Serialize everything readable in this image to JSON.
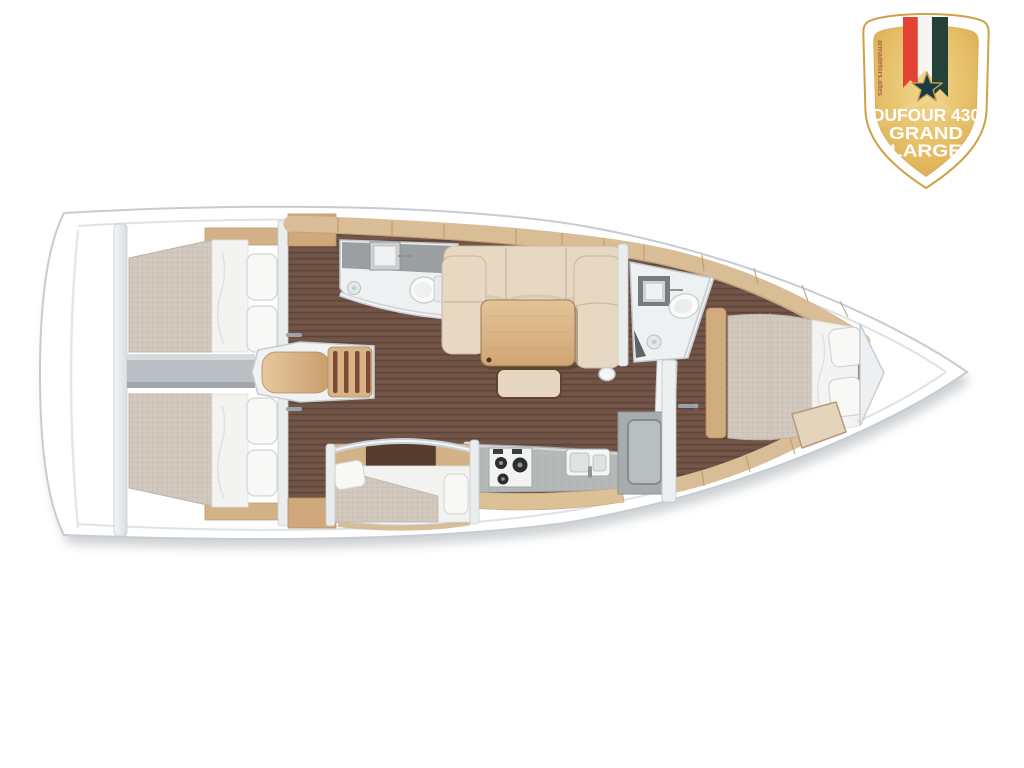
{
  "badge": {
    "title_line1": "DUFOUR 430",
    "title_line2": "GRAND",
    "title_line3": "LARGE",
    "watermark": "armadefors.altes",
    "colors": {
      "gold": "#e2b45f",
      "gold_light": "#f2d88f",
      "gold_dark": "#d3a149",
      "outline_gold": "#cfa045",
      "border_white": "#ffffff",
      "ribbon_red": "#e54236",
      "ribbon_white": "#f7f5f2",
      "ribbon_green": "#24413a",
      "star": "#1c3a46",
      "text": "#ffffff",
      "watermark": "#8a4a42"
    }
  },
  "floorplan": {
    "vessel": "sailboat-deck-plan",
    "orientation": "bow-right",
    "rooms": [
      "aft-port-cabin",
      "aft-starboard-cabin",
      "engine-compartment",
      "companionway-stairs",
      "port-head",
      "saloon",
      "forward-head",
      "galley",
      "starboard-mid-cabin",
      "forward-owner-cabin",
      "bow-locker"
    ],
    "features": [
      "double-bed",
      "pillows",
      "toilet",
      "washbasin",
      "shower-drain",
      "u-shaped-sofa",
      "dining-table",
      "stool",
      "mast-post",
      "stove",
      "galley-sink",
      "fridge",
      "island-bed",
      "bench-seat",
      "wood-lockers"
    ],
    "colors": {
      "hull_white": "#ffffff",
      "hull_outline": "#c6ccd1",
      "deck_line": "#dde2e5",
      "floor_wood": "#6f5346",
      "floor_plank_line": "#5d4437",
      "furniture_wood": "#dcc09a",
      "locker_wood": "#cfa97b",
      "mattress_beige": "#d3cabf",
      "bedding_white": "#f3f3f1",
      "counter_gray": "#b4b9b8",
      "wall_gray": "#e9edee",
      "shadow": "#8d949a"
    }
  }
}
